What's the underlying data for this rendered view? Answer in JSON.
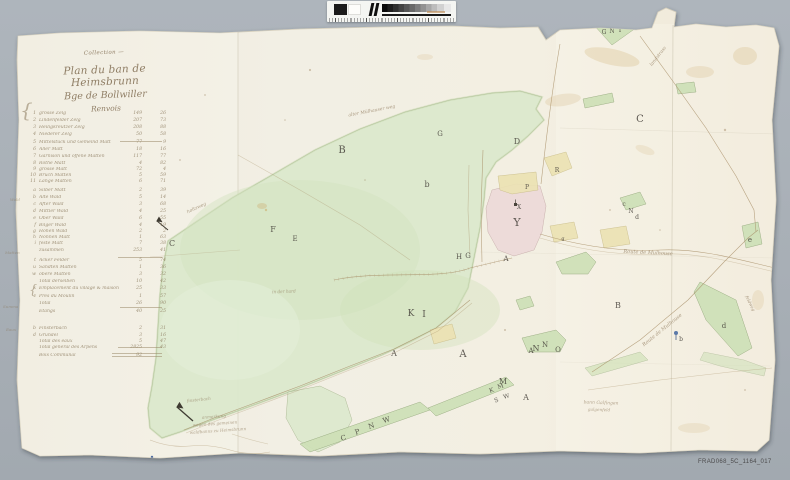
{
  "scan": {
    "reference_code": "FRAD068_5C_1164_017"
  },
  "colors": {
    "background": "#a8afb6",
    "paper": "#f1eee2",
    "forest_green": "#dce8cd",
    "parcel_green": "#cde0b6",
    "village_pink": "#ecd9d8",
    "parcel_yellow": "#ebe2b2",
    "ink": "#45403a",
    "handwriting": "#8b7a5e"
  },
  "calibration_bar": {
    "description": "grayscale step wedge with black and white reference patches and ruler ticks",
    "patches": [
      "black",
      "white"
    ],
    "wedge_steps": 12,
    "ruler": true
  },
  "title_block": {
    "note": "Collection —",
    "line1": "Plan du ban de Heimsbrunn",
    "line2": "Bge de Bollwiller",
    "line3": "Renvois"
  },
  "index": {
    "rows": [
      {
        "y": 115,
        "no": "1",
        "label": "grosse Zelg",
        "a": "149",
        "b": "26"
      },
      {
        "y": 122,
        "no": "2",
        "label": "Lindenfelder Zelg",
        "a": "207",
        "b": "73"
      },
      {
        "y": 129,
        "no": "3",
        "label": "Heiligkreutzer Zelg",
        "a": "208",
        "b": "88"
      },
      {
        "y": 136,
        "no": "4",
        "label": "Niederer Zelg",
        "a": "50",
        "b": "58"
      },
      {
        "y": 144,
        "no": "5",
        "label": "Mittelstück und Gemeind Matt",
        "a": "77",
        "b": "9"
      },
      {
        "y": 151,
        "no": "6",
        "label": "Aller Matt",
        "a": "18",
        "b": "16"
      },
      {
        "y": 158,
        "no": "7",
        "label": "Garnison und offene Matten",
        "a": "117",
        "b": "77"
      },
      {
        "y": 165,
        "no": "8",
        "label": "Rothe Matt",
        "a": "4",
        "b": "82"
      },
      {
        "y": 171,
        "no": "9",
        "label": "grosse Matt",
        "a": "72",
        "b": "4"
      },
      {
        "y": 177,
        "no": "10",
        "label": "Bruch Matten",
        "a": "5",
        "b": "59"
      },
      {
        "y": 183,
        "no": "11",
        "label": "Lange Matten",
        "a": "6",
        "b": "71"
      },
      {
        "y": 192,
        "no": "a",
        "label": "Silber Matt",
        "a": "2",
        "b": "39"
      },
      {
        "y": 199,
        "no": "b",
        "label": "Alte Wald",
        "a": "5",
        "b": "14"
      },
      {
        "y": 206,
        "no": "c",
        "label": "After Wald",
        "a": "3",
        "b": "68"
      },
      {
        "y": 213,
        "no": "d",
        "label": "Mittler Wald",
        "a": "4",
        "b": "25"
      },
      {
        "y": 220,
        "no": "e",
        "label": "Ober Wald",
        "a": "6",
        "b": "55"
      },
      {
        "y": 227,
        "no": "f",
        "label": "Bilger Wald",
        "a": "4",
        "b": "19"
      },
      {
        "y": 233,
        "no": "g",
        "label": "Hohen Wald",
        "a": "2",
        "b": "2"
      },
      {
        "y": 239,
        "no": "h",
        "label": "Nonnen Matt",
        "a": "1",
        "b": "63"
      },
      {
        "y": 245,
        "no": "i",
        "label": "feste Matt",
        "a": "7",
        "b": "38"
      },
      {
        "y": 252,
        "no": "",
        "label": "zusammen",
        "a": "253",
        "b": "41"
      },
      {
        "y": 262,
        "no": "t",
        "label": "Acker Felder",
        "a": "5",
        "b": "74"
      },
      {
        "y": 269,
        "no": "u",
        "label": "Sandten Matten",
        "a": "1",
        "b": "36"
      },
      {
        "y": 276,
        "no": "w",
        "label": "obere Matten",
        "a": "3",
        "b": "32"
      },
      {
        "y": 283,
        "no": "",
        "label": "Total derselben",
        "a": "10",
        "b": "42"
      },
      {
        "y": 290,
        "no": "x",
        "label": "Emplacement du village & maisons",
        "a": "25",
        "b": "33"
      },
      {
        "y": 298,
        "no": "z",
        "label": "Prés du Moulin",
        "a": "1",
        "b": "57"
      },
      {
        "y": 305,
        "no": "",
        "label": "Total",
        "a": "26",
        "b": "90"
      },
      {
        "y": 313,
        "no": "",
        "label": "Etangs",
        "a": "40",
        "b": "25"
      },
      {
        "y": 330,
        "no": "b",
        "label": "Finsterbach",
        "a": "2",
        "b": "31"
      },
      {
        "y": 337,
        "no": "d",
        "label": "Grundel",
        "a": "3",
        "b": "16"
      },
      {
        "y": 343,
        "no": "",
        "label": "Total des eaux",
        "a": "5",
        "b": "47"
      },
      {
        "y": 349,
        "no": "",
        "label": "Total général des Arpens",
        "a": "2825",
        "b": "43"
      },
      {
        "y": 357,
        "no": "",
        "label": "Bois Communal",
        "a": "92",
        "b": ""
      }
    ],
    "margin_notes": [
      {
        "t": "{",
        "x": 20,
        "y": 118,
        "s": 20
      },
      {
        "t": "Wald",
        "x": 10,
        "y": 201,
        "s": 4
      },
      {
        "t": "Matten",
        "x": 5,
        "y": 254,
        "s": 4
      },
      {
        "t": "{",
        "x": 29,
        "y": 296,
        "s": 13
      },
      {
        "t": "Summa",
        "x": 3,
        "y": 308,
        "s": 4
      },
      {
        "t": "Eaux",
        "x": 6,
        "y": 331,
        "s": 4
      }
    ]
  },
  "map": {
    "letters": [
      {
        "t": "B",
        "x": 342,
        "y": 153,
        "s": 10
      },
      {
        "t": "D",
        "x": 517,
        "y": 144,
        "s": 8
      },
      {
        "t": "G",
        "x": 440,
        "y": 136,
        "s": 7
      },
      {
        "t": "C",
        "x": 640,
        "y": 122,
        "s": 10
      },
      {
        "t": "C",
        "x": 172,
        "y": 246,
        "s": 8
      },
      {
        "t": "F",
        "x": 273,
        "y": 232,
        "s": 8
      },
      {
        "t": "E",
        "x": 295,
        "y": 241,
        "s": 7
      },
      {
        "t": "b",
        "x": 427,
        "y": 187,
        "s": 8
      },
      {
        "t": "H",
        "x": 459,
        "y": 259,
        "s": 7
      },
      {
        "t": "G",
        "x": 468,
        "y": 258,
        "s": 7
      },
      {
        "t": "K",
        "x": 411,
        "y": 316,
        "s": 9
      },
      {
        "t": "I",
        "x": 424,
        "y": 317,
        "s": 9
      },
      {
        "t": "A",
        "x": 394,
        "y": 356,
        "s": 8
      },
      {
        "t": "A",
        "x": 463,
        "y": 357,
        "s": 10
      },
      {
        "t": "A",
        "x": 506,
        "y": 261,
        "s": 7
      },
      {
        "t": "Y",
        "x": 517,
        "y": 226,
        "s": 11
      },
      {
        "t": "N",
        "x": 536,
        "y": 351,
        "s": 8
      },
      {
        "t": "M",
        "x": 503,
        "y": 384,
        "s": 8
      },
      {
        "t": "A",
        "x": 526,
        "y": 400,
        "s": 8
      },
      {
        "t": "B",
        "x": 618,
        "y": 308,
        "s": 8
      },
      {
        "t": "d",
        "x": 724,
        "y": 328,
        "s": 7
      },
      {
        "t": "e",
        "x": 750,
        "y": 242,
        "s": 7
      },
      {
        "t": "g",
        "x": 563,
        "y": 240,
        "s": 5
      },
      {
        "t": "c",
        "x": 624,
        "y": 206,
        "s": 6
      },
      {
        "t": "N",
        "x": 631,
        "y": 213,
        "s": 6
      },
      {
        "t": "d",
        "x": 637,
        "y": 219,
        "s": 6
      },
      {
        "t": "G",
        "x": 604,
        "y": 34,
        "s": 6
      },
      {
        "t": "N",
        "x": 612,
        "y": 33,
        "s": 6
      },
      {
        "t": "T",
        "x": 620,
        "y": 32,
        "s": 6
      },
      {
        "t": "C",
        "x": 344,
        "y": 440,
        "s": 7,
        "r": -18
      },
      {
        "t": "P",
        "x": 358,
        "y": 434,
        "s": 7,
        "r": -18
      },
      {
        "t": "N",
        "x": 372,
        "y": 428,
        "s": 7,
        "r": -18
      },
      {
        "t": "W",
        "x": 387,
        "y": 422,
        "s": 7,
        "r": -18
      },
      {
        "t": "K",
        "x": 492,
        "y": 392,
        "s": 6,
        "r": -18
      },
      {
        "t": "M",
        "x": 501,
        "y": 388,
        "s": 6,
        "r": -18
      },
      {
        "t": "S",
        "x": 497,
        "y": 402,
        "s": 6,
        "r": -18
      },
      {
        "t": "W",
        "x": 507,
        "y": 398,
        "s": 6,
        "r": -18
      },
      {
        "t": "A",
        "x": 531,
        "y": 353,
        "s": 7
      },
      {
        "t": "N",
        "x": 545,
        "y": 347,
        "s": 7
      },
      {
        "t": "O",
        "x": 558,
        "y": 352,
        "s": 7
      },
      {
        "t": "P",
        "x": 527,
        "y": 189,
        "s": 6
      },
      {
        "t": "R",
        "x": 557,
        "y": 172,
        "s": 6
      },
      {
        "t": "X",
        "x": 519,
        "y": 209,
        "s": 6
      },
      {
        "t": "b",
        "x": 681,
        "y": 341,
        "s": 6
      }
    ],
    "road_labels": [
      {
        "t": "Route de Mulhouse",
        "x": 648,
        "y": 254,
        "s": 5,
        "r": 3
      },
      {
        "t": "Route de Mulhouse",
        "x": 663,
        "y": 331,
        "s": 5,
        "r": -39
      },
      {
        "t": "landstrass",
        "x": 659,
        "y": 57,
        "s": 4.5,
        "r": -52
      },
      {
        "t": "alter Mülhauser weg",
        "x": 372,
        "y": 112,
        "s": 4.5,
        "r": -11
      },
      {
        "t": "holtzweg",
        "x": 197,
        "y": 209,
        "s": 4.5,
        "r": -25
      },
      {
        "t": "feldweg",
        "x": 749,
        "y": 304,
        "s": 4.2,
        "r": 64
      }
    ],
    "annotations": [
      {
        "t": "in der hard",
        "x": 284,
        "y": 293,
        "s": 4.2,
        "r": -2
      },
      {
        "t": "bann Galfingen",
        "x": 601,
        "y": 404,
        "s": 4.5,
        "r": 2
      },
      {
        "t": "galgenfeld",
        "x": 599,
        "y": 411,
        "s": 4.2,
        "r": 2
      },
      {
        "t": "finsterbach",
        "x": 199,
        "y": 401,
        "s": 4.2,
        "r": -6
      },
      {
        "t": "anmerkung",
        "x": 214,
        "y": 418,
        "s": 4.2,
        "r": -4
      },
      {
        "t": "wegen des gemeinen",
        "x": 215,
        "y": 425,
        "s": 4.2,
        "r": -4
      },
      {
        "t": "waldbanns zu Heimsbrunn",
        "x": 218,
        "y": 432,
        "s": 4.2,
        "r": -4
      }
    ]
  }
}
